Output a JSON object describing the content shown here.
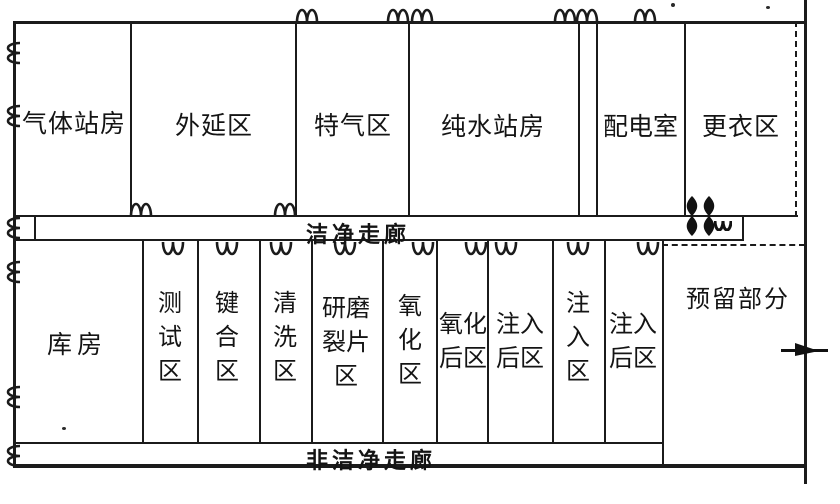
{
  "plan": {
    "background": "#ffffff",
    "wall_color": "#1b1b1b",
    "rooms_top": [
      {
        "label": "气体站房"
      },
      {
        "label": "外延区"
      },
      {
        "label": "特气区"
      },
      {
        "label": "纯水站房"
      },
      {
        "label": "配电室"
      },
      {
        "label": "更衣区"
      }
    ],
    "corridor_clean": {
      "label": "洁净走廊"
    },
    "rooms_bottom": [
      {
        "label": "库房"
      },
      {
        "label": "测试区"
      },
      {
        "label": "键合区"
      },
      {
        "label": "清洗区"
      },
      {
        "label": "研磨裂片区"
      },
      {
        "label": "氧化区"
      },
      {
        "label": "氧化后区"
      },
      {
        "label": "注入后区"
      },
      {
        "label": "注入区"
      },
      {
        "label": "注入后区"
      },
      {
        "label": "预留部分"
      }
    ],
    "corridor_non_clean": {
      "label": "非洁净走廊"
    },
    "icons": {
      "door": "door-swing-icon",
      "door_filled": "door-swing-filled-icon",
      "entrance_arrow": "entrance-arrow-icon"
    }
  }
}
